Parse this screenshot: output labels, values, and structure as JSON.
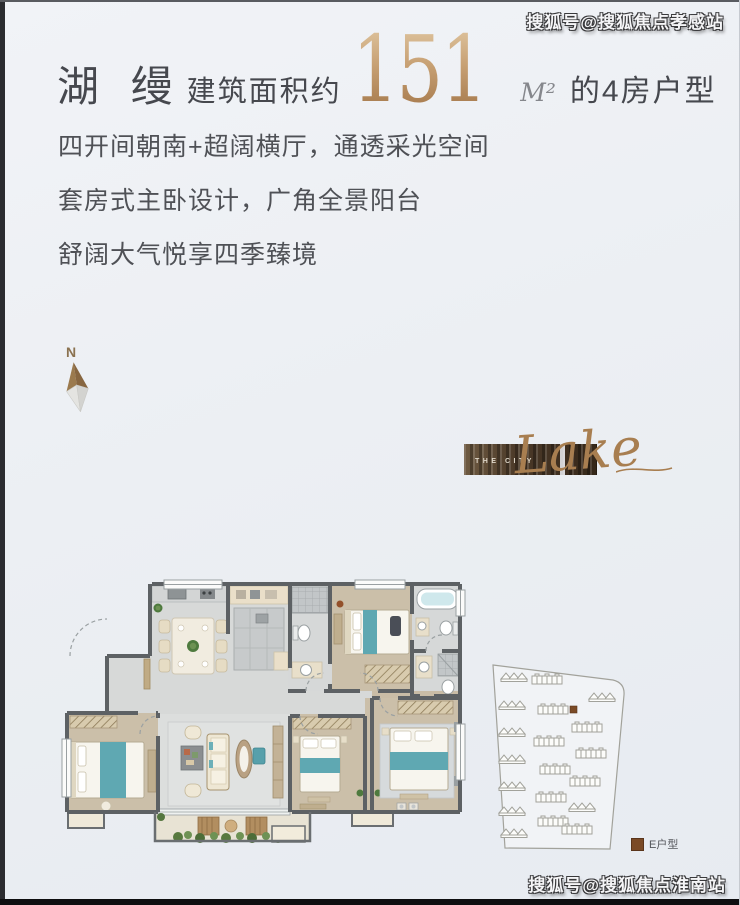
{
  "watermarks": {
    "top_right": "搜狐号@搜狐焦点孝感站",
    "bottom_right": "搜狐号@搜狐焦点淮南站"
  },
  "header": {
    "title": "湖 缦",
    "area_prefix": "建筑面积约",
    "area_value": "151",
    "area_unit": "M²",
    "area_suffix": "的4房户型"
  },
  "features": [
    "四开间朝南+超阔横厅，通透采光空间",
    "套房式主卧设计，广角全景阳台",
    "舒阔大气悦享四季臻境"
  ],
  "compass": {
    "label": "N"
  },
  "logo": {
    "brand": "THE CITY",
    "script": "Lake"
  },
  "site_plan": {
    "legend_label": "E户型",
    "highlight_color": "#7a4a26"
  },
  "floor_plan": {
    "bedrooms": "4",
    "wall_color": "#5d6164",
    "teal_accent": "#5fa8b2",
    "wood_floor": "#cbbfa9",
    "marble_floor": "#d7d9d8",
    "balcony_floor": "#e8e3d4"
  },
  "palette": {
    "background": "#eceff4",
    "gold": "#b68b5c",
    "text_dark": "#4a4c52"
  }
}
